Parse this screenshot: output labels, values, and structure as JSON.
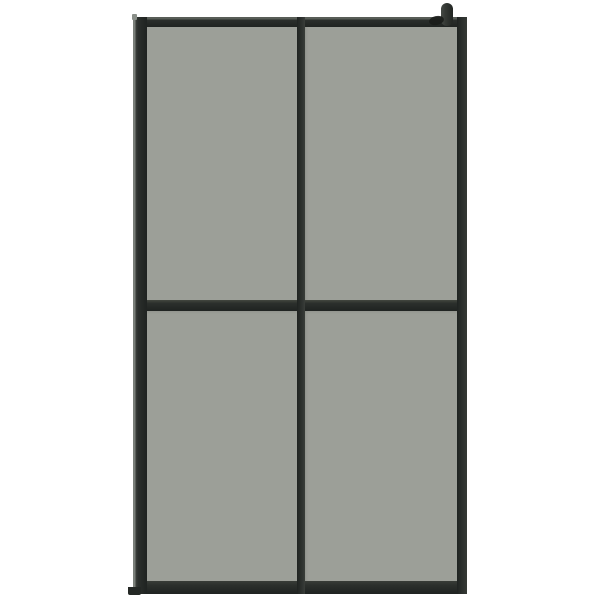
{
  "scene": {
    "type": "product-photo",
    "subject": "walk-in-shower-screen",
    "pane_rows": 2,
    "pane_columns": 2,
    "pane_count": 4,
    "parts": [
      "frame-top-rail",
      "frame-bottom-rail",
      "frame-left-stile",
      "frame-right-stile",
      "frame-center-mullion",
      "frame-mid-rail",
      "glass-pane-top-left",
      "glass-pane-top-right",
      "glass-pane-bottom-left",
      "glass-pane-bottom-right",
      "wall-bracket-knob",
      "wall-bracket-shadow"
    ]
  },
  "colors": {
    "background": "#ffffff",
    "frame": "#2b2f2c",
    "frame_dark": "#1f2321",
    "frame_highlight": "#7a7f79",
    "frame_edge_light": "#585d57",
    "glass": "#9c9f98",
    "bracket": "#333733",
    "bracket_shadow": "#191c1a"
  }
}
